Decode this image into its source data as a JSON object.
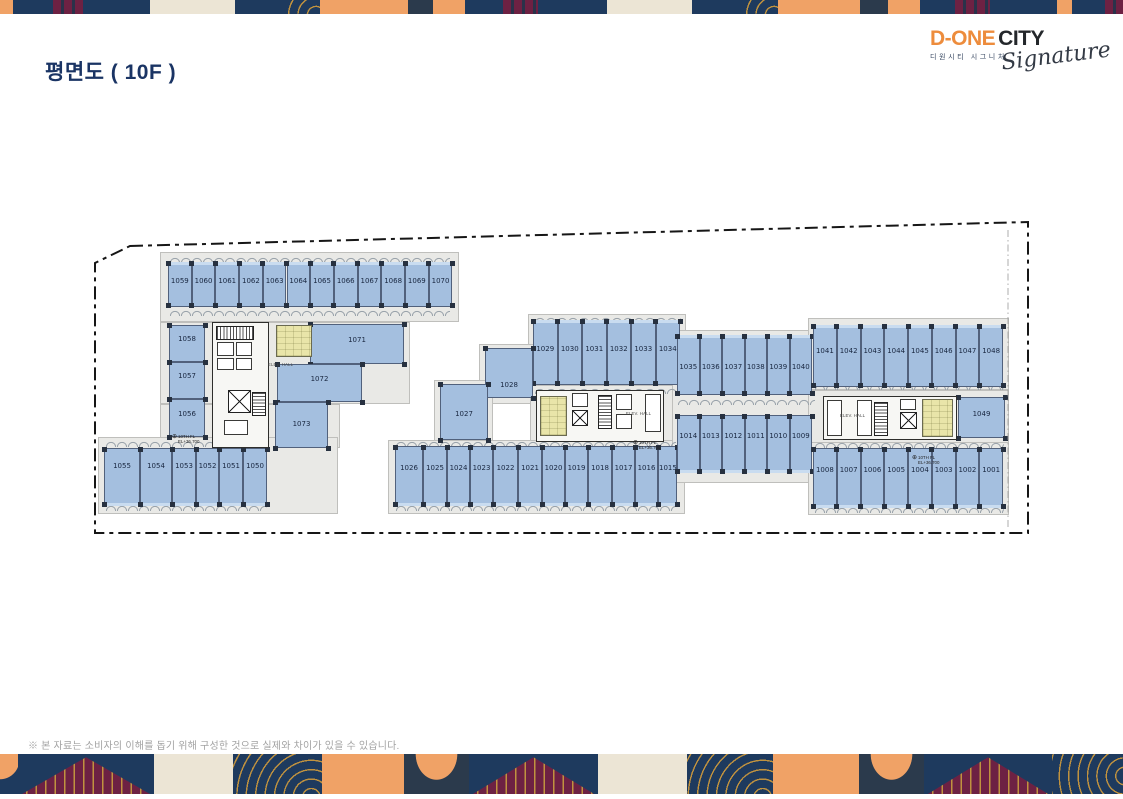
{
  "header": {
    "title": "평면도 ( 10F )"
  },
  "logo": {
    "brand_primary": "D-ONE",
    "brand_secondary": "CITY",
    "brand_sub_korean": "디원시티 시그니처",
    "brand_script": "Signature"
  },
  "footer": {
    "disclaimer": "※ 본 자료는 소비자의 이해를 돕기 위해 구성한 것으로 실제와 차이가 있을 수 있습니다."
  },
  "palette": {
    "navy": "#1e3a5e",
    "orange": "#f0a266",
    "cream": "#ece5d5",
    "slate": "#2b3a4c",
    "maroon": "#6d2143",
    "gold": "#c0923f",
    "title": "#1a3464",
    "logoOrange": "#ed8c3c",
    "unit": "#a4bfdf",
    "unitBorder": "#51617c",
    "corridor": "#e9e9e6",
    "column": "#273140",
    "coreWall": "#2e2e2c",
    "yellow": "#e9e5a9"
  },
  "bands": {
    "top": [
      {
        "w": 13,
        "t": "orange"
      },
      {
        "w": 40,
        "t": "navy"
      },
      {
        "w": 30,
        "t": "mstripes"
      },
      {
        "w": 67,
        "t": "navy"
      },
      {
        "w": 85,
        "t": "cream"
      },
      {
        "w": 52,
        "t": "navy"
      },
      {
        "w": 33,
        "t": "arcs"
      },
      {
        "w": 88,
        "t": "orange"
      },
      {
        "w": 25,
        "t": "slate"
      },
      {
        "w": 32,
        "t": "orange"
      },
      {
        "w": 38,
        "t": "navy"
      },
      {
        "w": 35,
        "t": "mstripes"
      },
      {
        "w": 69,
        "t": "navy"
      },
      {
        "w": 85,
        "t": "cream"
      },
      {
        "w": 53,
        "t": "navy"
      },
      {
        "w": 33,
        "t": "arcs"
      },
      {
        "w": 82,
        "t": "orange"
      },
      {
        "w": 28,
        "t": "slate"
      },
      {
        "w": 32,
        "t": "orange"
      },
      {
        "w": 35,
        "t": "navy"
      },
      {
        "w": 35,
        "t": "mstripes"
      },
      {
        "w": 67,
        "t": "navy"
      },
      {
        "w": 15,
        "t": "orange"
      },
      {
        "w": 33,
        "t": "navy"
      },
      {
        "w": 18,
        "t": "mstripes"
      }
    ],
    "bottom": [
      {
        "w": 18,
        "t": "ocorner"
      },
      {
        "w": 136,
        "t": "tri"
      },
      {
        "w": 79,
        "t": "cream"
      },
      {
        "w": 89,
        "t": "arcs"
      },
      {
        "w": 82,
        "t": "orange"
      },
      {
        "w": 65,
        "t": "ellipse"
      },
      {
        "w": 129,
        "t": "tri"
      },
      {
        "w": 89,
        "t": "cream"
      },
      {
        "w": 86,
        "t": "arcs"
      },
      {
        "w": 86,
        "t": "orange"
      },
      {
        "w": 65,
        "t": "ellipse"
      },
      {
        "w": 128,
        "t": "tri"
      },
      {
        "w": 71,
        "t": "arcsR"
      }
    ]
  },
  "plan": {
    "boundary_points": "130,246 1028,222 1028,533 95,533 95,263",
    "inner_line": {
      "x1": 1008,
      "y1": 230,
      "x2": 1008,
      "y2": 530
    },
    "corridors": [
      {
        "x": 160,
        "y": 252,
        "w": 299,
        "h": 70
      },
      {
        "x": 160,
        "y": 322,
        "w": 250,
        "h": 82
      },
      {
        "x": 160,
        "y": 404,
        "w": 180,
        "h": 44
      },
      {
        "x": 98,
        "y": 437,
        "w": 240,
        "h": 77
      },
      {
        "x": 528,
        "y": 314,
        "w": 158,
        "h": 74
      },
      {
        "x": 479,
        "y": 344,
        "w": 59,
        "h": 60
      },
      {
        "x": 434,
        "y": 380,
        "w": 59,
        "h": 62
      },
      {
        "x": 530,
        "y": 385,
        "w": 155,
        "h": 62
      },
      {
        "x": 388,
        "y": 440,
        "w": 297,
        "h": 74
      },
      {
        "x": 672,
        "y": 330,
        "w": 146,
        "h": 153
      },
      {
        "x": 808,
        "y": 318,
        "w": 201,
        "h": 72
      },
      {
        "x": 808,
        "y": 390,
        "w": 201,
        "h": 57
      },
      {
        "x": 808,
        "y": 442,
        "w": 201,
        "h": 73
      }
    ],
    "scallops": [
      {
        "x": 170,
        "y": 256,
        "w": 280
      },
      {
        "x": 170,
        "y": 309,
        "w": 280
      },
      {
        "x": 106,
        "y": 440,
        "w": 161
      },
      {
        "x": 106,
        "y": 504,
        "w": 161
      },
      {
        "x": 535,
        "y": 316,
        "w": 146
      },
      {
        "x": 535,
        "y": 387,
        "w": 146
      },
      {
        "x": 396,
        "y": 440,
        "w": 280
      },
      {
        "x": 396,
        "y": 504,
        "w": 280
      },
      {
        "x": 678,
        "y": 398,
        "w": 137
      },
      {
        "x": 815,
        "y": 383,
        "w": 189
      },
      {
        "x": 815,
        "y": 441,
        "w": 189
      },
      {
        "x": 815,
        "y": 506,
        "w": 189
      }
    ],
    "rows": [
      {
        "x": 168,
        "y": 262,
        "h": 45,
        "edge": "top",
        "label_at": 0.42,
        "units": [
          {
            "id": "1059",
            "w": 23.7
          },
          {
            "id": "1060",
            "w": 23.7
          },
          {
            "id": "1061",
            "w": 23.7
          },
          {
            "id": "1062",
            "w": 23.7
          },
          {
            "id": "1063",
            "w": 23.7
          },
          {
            "id": "1064",
            "w": 23.7
          },
          {
            "id": "1065",
            "w": 23.7
          },
          {
            "id": "1066",
            "w": 23.7
          },
          {
            "id": "1067",
            "w": 23.7
          },
          {
            "id": "1068",
            "w": 23.7
          },
          {
            "id": "1069",
            "w": 23.7
          },
          {
            "id": "1070",
            "w": 23.7
          }
        ]
      },
      {
        "x": 104,
        "y": 448,
        "h": 58,
        "edge": "bottom",
        "label_at": 0.3,
        "units": [
          {
            "id": "1055",
            "w": 36
          },
          {
            "id": "1054",
            "w": 32
          },
          {
            "id": "1053",
            "w": 24
          },
          {
            "id": "1052",
            "w": 23
          },
          {
            "id": "1051",
            "w": 24
          },
          {
            "id": "1050",
            "w": 24
          }
        ]
      },
      {
        "x": 533,
        "y": 320,
        "h": 65,
        "edge": "top",
        "label_at": 0.44,
        "units": [
          {
            "id": "1029",
            "w": 24.5
          },
          {
            "id": "1030",
            "w": 24.5
          },
          {
            "id": "1031",
            "w": 24.5
          },
          {
            "id": "1032",
            "w": 24.5
          },
          {
            "id": "1033",
            "w": 24.5
          },
          {
            "id": "1034",
            "w": 24.5
          }
        ]
      },
      {
        "x": 395,
        "y": 446,
        "h": 60,
        "edge": "bottom",
        "label_at": 0.36,
        "units": [
          {
            "id": "1026",
            "w": 28
          },
          {
            "id": "1025",
            "w": 24
          },
          {
            "id": "1024",
            "w": 23
          },
          {
            "id": "1023",
            "w": 23
          },
          {
            "id": "1022",
            "w": 25
          },
          {
            "id": "1021",
            "w": 24
          },
          {
            "id": "1020",
            "w": 23
          },
          {
            "id": "1019",
            "w": 23
          },
          {
            "id": "1018",
            "w": 24
          },
          {
            "id": "1017",
            "w": 23
          },
          {
            "id": "1016",
            "w": 23
          },
          {
            "id": "1015",
            "w": 19
          }
        ]
      },
      {
        "x": 677,
        "y": 335,
        "h": 60,
        "edge": "top",
        "label_at": 0.53,
        "units": [
          {
            "id": "1035",
            "w": 22.5
          },
          {
            "id": "1036",
            "w": 22.5
          },
          {
            "id": "1037",
            "w": 22.5
          },
          {
            "id": "1038",
            "w": 22.5
          },
          {
            "id": "1039",
            "w": 22.5
          },
          {
            "id": "1040",
            "w": 22.5
          }
        ]
      },
      {
        "x": 677,
        "y": 415,
        "h": 58,
        "edge": "bottom",
        "label_at": 0.36,
        "units": [
          {
            "id": "1014",
            "w": 22.5
          },
          {
            "id": "1013",
            "w": 22.5
          },
          {
            "id": "1012",
            "w": 22.5
          },
          {
            "id": "1011",
            "w": 22.5
          },
          {
            "id": "1010",
            "w": 22.5
          },
          {
            "id": "1009",
            "w": 22.5
          }
        ]
      },
      {
        "x": 813,
        "y": 325,
        "h": 62,
        "edge": "top",
        "label_at": 0.42,
        "units": [
          {
            "id": "1041",
            "w": 23.75
          },
          {
            "id": "1042",
            "w": 23.75
          },
          {
            "id": "1043",
            "w": 23.75
          },
          {
            "id": "1044",
            "w": 23.75
          },
          {
            "id": "1045",
            "w": 23.75
          },
          {
            "id": "1046",
            "w": 23.75
          },
          {
            "id": "1047",
            "w": 23.75
          },
          {
            "id": "1048",
            "w": 23.75
          }
        ]
      },
      {
        "x": 813,
        "y": 448,
        "h": 60,
        "edge": "bottom",
        "label_at": 0.37,
        "units": [
          {
            "id": "1008",
            "w": 23.75
          },
          {
            "id": "1007",
            "w": 23.75
          },
          {
            "id": "1006",
            "w": 23.75
          },
          {
            "id": "1005",
            "w": 23.75
          },
          {
            "id": "1004",
            "w": 23.75
          },
          {
            "id": "1003",
            "w": 23.75
          },
          {
            "id": "1002",
            "w": 23.75
          },
          {
            "id": "1001",
            "w": 23.75
          }
        ]
      }
    ],
    "units_abs": [
      {
        "id": "1058",
        "x": 169,
        "y": 325,
        "w": 36,
        "h": 37,
        "label_at": 0.38
      },
      {
        "id": "1057",
        "x": 169,
        "y": 362,
        "w": 36,
        "h": 37,
        "label_at": 0.38
      },
      {
        "id": "1056",
        "x": 169,
        "y": 399,
        "w": 36,
        "h": 38,
        "label_at": 0.38
      },
      {
        "id": "1071",
        "x": 310,
        "y": 324,
        "w": 94,
        "h": 40,
        "label_at": 0.4
      },
      {
        "id": "1072",
        "x": 277,
        "y": 364,
        "w": 85,
        "h": 38,
        "label_at": 0.38
      },
      {
        "id": "1073",
        "x": 275,
        "y": 402,
        "w": 53,
        "h": 46,
        "label_at": 0.48
      },
      {
        "id": "1028",
        "x": 485,
        "y": 348,
        "w": 48,
        "h": 50,
        "label_at": 0.74
      },
      {
        "id": "1027",
        "x": 440,
        "y": 384,
        "w": 48,
        "h": 56,
        "label_at": 0.54
      },
      {
        "id": "1049",
        "x": 958,
        "y": 397,
        "w": 47,
        "h": 41,
        "label_at": 0.42
      }
    ],
    "cores": [
      {
        "x": 212,
        "y": 322,
        "w": 57,
        "h": 126,
        "parts": [
          {
            "t": "stairs",
            "o": "v",
            "x": 216,
            "y": 326,
            "w": 38,
            "h": 14
          },
          {
            "t": "room",
            "x": 217,
            "y": 342,
            "w": 17,
            "h": 14
          },
          {
            "t": "room",
            "x": 236,
            "y": 342,
            "w": 16,
            "h": 14
          },
          {
            "t": "room",
            "x": 217,
            "y": 358,
            "w": 17,
            "h": 12
          },
          {
            "t": "room",
            "x": 236,
            "y": 358,
            "w": 16,
            "h": 12
          },
          {
            "t": "ev",
            "x": 228,
            "y": 390,
            "w": 23,
            "h": 23
          },
          {
            "t": "stairs",
            "o": "h",
            "x": 252,
            "y": 392,
            "w": 14,
            "h": 24
          },
          {
            "t": "room",
            "x": 224,
            "y": 420,
            "w": 24,
            "h": 15
          },
          {
            "t": "wc",
            "x": 276,
            "y": 325,
            "w": 36,
            "h": 32
          }
        ]
      },
      {
        "x": 536,
        "y": 390,
        "w": 128,
        "h": 52,
        "parts": [
          {
            "t": "wc",
            "x": 540,
            "y": 396,
            "w": 27,
            "h": 40
          },
          {
            "t": "room",
            "x": 572,
            "y": 393,
            "w": 16,
            "h": 14
          },
          {
            "t": "ev",
            "x": 572,
            "y": 410,
            "w": 16,
            "h": 16
          },
          {
            "t": "stairs",
            "o": "h",
            "x": 598,
            "y": 395,
            "w": 14,
            "h": 34
          },
          {
            "t": "room",
            "x": 616,
            "y": 394,
            "w": 16,
            "h": 16
          },
          {
            "t": "room",
            "x": 616,
            "y": 414,
            "w": 16,
            "h": 15
          },
          {
            "t": "room",
            "x": 645,
            "y": 394,
            "w": 16,
            "h": 38
          }
        ]
      },
      {
        "x": 823,
        "y": 396,
        "w": 134,
        "h": 44,
        "parts": [
          {
            "t": "room",
            "x": 827,
            "y": 400,
            "w": 15,
            "h": 36
          },
          {
            "t": "room",
            "x": 857,
            "y": 400,
            "w": 15,
            "h": 36
          },
          {
            "t": "stairs",
            "o": "h",
            "x": 874,
            "y": 402,
            "w": 14,
            "h": 34
          },
          {
            "t": "room",
            "x": 900,
            "y": 399,
            "w": 16,
            "h": 11
          },
          {
            "t": "ev",
            "x": 900,
            "y": 412,
            "w": 17,
            "h": 17
          },
          {
            "t": "wc",
            "x": 922,
            "y": 399,
            "w": 31,
            "h": 38
          }
        ]
      }
    ],
    "core_labels": [
      {
        "text": "ELEV. HALL",
        "x": 268,
        "y": 362
      },
      {
        "text": "ELEV. HALL",
        "x": 626,
        "y": 411
      },
      {
        "text": "ELEV. HALL",
        "x": 840,
        "y": 413
      }
    ],
    "level_marker": {
      "line1": "10TH FL",
      "line2": "EL+36.700",
      "positions": [
        {
          "x": 172,
          "y": 434
        },
        {
          "x": 633,
          "y": 440
        },
        {
          "x": 912,
          "y": 455
        }
      ]
    }
  }
}
